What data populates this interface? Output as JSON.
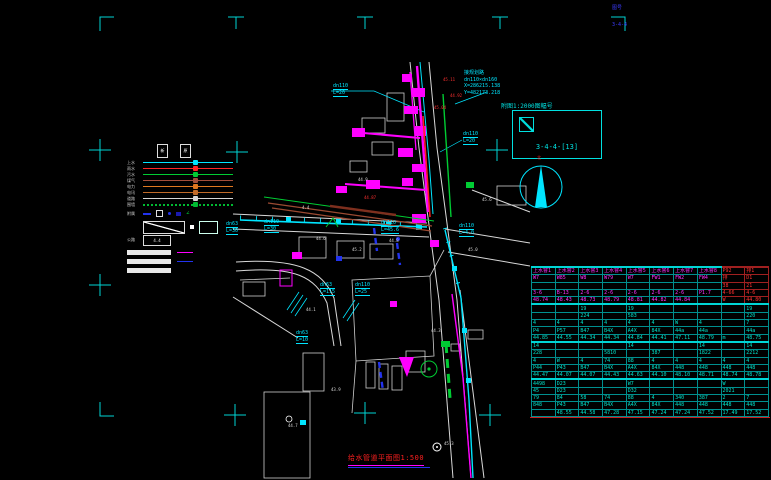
{
  "canvas": {
    "width": 771,
    "height": 480,
    "background": "#000000"
  },
  "title_block": {
    "text": "给水管道平面图",
    "scale": "1:500"
  },
  "detail_locator": {
    "caption": "附图1:2000图幅号",
    "sheet_code": "3-4-4-[13]"
  },
  "north_arrow": {
    "label": "北"
  },
  "corner_notes": [
    {
      "text": "图号",
      "x": 612,
      "y": 5
    },
    {
      "text": "3-4-4",
      "x": 612,
      "y": 22
    }
  ],
  "survey_note": {
    "lines": [
      "接规划路",
      "dn110×dn160",
      "X=286215.138",
      "Y=482173.218"
    ]
  },
  "legend": {
    "col_headers": [
      "新",
      "原"
    ],
    "lines": [
      {
        "label": "上水",
        "color": "#00e5ff",
        "dotted": false
      },
      {
        "label": "雨水",
        "color": "#ff2525",
        "dotted": false
      },
      {
        "label": "污水",
        "color": "#00cc33",
        "dotted": false
      },
      {
        "label": "煤气",
        "color": "#a34f3c",
        "dotted": false
      },
      {
        "label": "电力",
        "color": "#e07820",
        "dotted": false
      },
      {
        "label": "电讯",
        "color": "#c06a28",
        "dotted": false
      },
      {
        "label": "道路",
        "color": "#d6d6d6",
        "dotted": false
      },
      {
        "label": "围墙",
        "color": "#00bb33",
        "dotted": true
      }
    ],
    "symbols_label": "附属",
    "road_label": "公路",
    "road_box_text": "4.4"
  },
  "pipe_labels": [
    {
      "size": "dn110",
      "len": "L=20",
      "x": 333,
      "y": 83
    },
    {
      "size": "dn110",
      "len": "L=20",
      "x": 463,
      "y": 131
    },
    {
      "size": "dn63",
      "len": "L=30",
      "x": 226,
      "y": 221
    },
    {
      "size": "dn110",
      "len": "L=30",
      "x": 264,
      "y": 219
    },
    {
      "size": "dn110",
      "len": "L=45.6",
      "x": 381,
      "y": 220
    },
    {
      "size": "dn110",
      "len": "L=4.0",
      "x": 459,
      "y": 223
    },
    {
      "size": "dn63",
      "len": "L=115",
      "x": 320,
      "y": 282
    },
    {
      "size": "dn110",
      "len": "L=25",
      "x": 355,
      "y": 282
    },
    {
      "size": "dn63",
      "len": "L=10",
      "x": 296,
      "y": 330
    }
  ],
  "map_labels": {
    "white": [
      {
        "t": "4.4",
        "x": 302,
        "y": 206
      },
      {
        "t": "44.6",
        "x": 316,
        "y": 237
      },
      {
        "t": "45.2",
        "x": 352,
        "y": 248
      },
      {
        "t": "44.8",
        "x": 389,
        "y": 239
      },
      {
        "t": "45.0",
        "x": 468,
        "y": 248
      },
      {
        "t": "44.1",
        "x": 306,
        "y": 308
      },
      {
        "t": "43.9",
        "x": 331,
        "y": 388
      },
      {
        "t": "44.3",
        "x": 431,
        "y": 329
      },
      {
        "t": "45.6",
        "x": 482,
        "y": 198
      },
      {
        "t": "44.9",
        "x": 358,
        "y": 178
      },
      {
        "t": "44.7",
        "x": 288,
        "y": 424
      },
      {
        "t": "45.3",
        "x": 444,
        "y": 442
      }
    ],
    "red": [
      {
        "t": "45.11",
        "x": 443,
        "y": 78
      },
      {
        "t": "44.92",
        "x": 450,
        "y": 94
      },
      {
        "t": "45.04",
        "x": 434,
        "y": 106
      },
      {
        "t": "44.87",
        "x": 364,
        "y": 196
      }
    ]
  },
  "table": {
    "columns": 10,
    "sections": [
      {
        "text_color": "#ff2fff",
        "accent_cols": [
          8,
          9
        ],
        "accent_color": "#ff3030",
        "rows": [
          [
            "上水窨1",
            "上水窨2",
            "上水窨3",
            "上水窨4",
            "上水窨5",
            "上水窨6",
            "上水窨7",
            "上水窨8",
            "P92",
            "排1"
          ],
          [
            "W7",
            "W85",
            "W8",
            "W79",
            "W7",
            "FW1",
            "FW2",
            "FW4",
            "排",
            "D1"
          ],
          [
            "",
            "",
            "",
            "",
            "",
            "",
            "",
            "",
            "38",
            "21"
          ],
          [
            "3-6",
            "B-13",
            "2-6",
            "2-6",
            "2-6",
            "2-6",
            "2-6",
            "P1.7",
            "4-66",
            "4-6"
          ],
          [
            "48.74",
            "48.43",
            "48.73",
            "48.79",
            "48.81",
            "44.82",
            "44.84",
            "",
            "W",
            "44.80"
          ]
        ]
      },
      {
        "text_color": "#00e0c8",
        "accent_cols": [],
        "accent_color": "",
        "rows": [
          [
            "",
            "",
            "19",
            "",
            "19",
            "",
            "",
            "",
            "",
            "19"
          ],
          [
            "",
            "",
            "224",
            "",
            "583",
            "",
            "",
            "",
            "",
            "220"
          ],
          [
            "4",
            "4",
            "4",
            "4",
            "4",
            "4",
            "W",
            "4",
            "",
            "7"
          ],
          [
            "P4",
            "P57",
            "B47",
            "B4X",
            "A4X",
            "84X",
            "44a",
            "44a",
            "",
            "44a"
          ],
          [
            "44.85",
            "44.55",
            "44.34",
            "44.34",
            "44.84",
            "44.41",
            "47.11",
            "48.79",
            "m",
            "48.75"
          ]
        ]
      },
      {
        "text_color": "#00e0c8",
        "accent_cols": [],
        "accent_color": "",
        "rows": [
          [
            "14",
            "",
            "",
            "",
            "14",
            "",
            "",
            "14",
            "",
            "14"
          ],
          [
            "228",
            "",
            "",
            "5810",
            "",
            "387",
            "",
            "1822",
            "",
            "2212"
          ],
          [
            "4",
            "W",
            "4",
            "74",
            "88",
            "4",
            "4",
            "4",
            "4",
            "4"
          ],
          [
            "P44",
            "P43",
            "B47",
            "B4X",
            "A4X",
            "84X",
            "448",
            "448",
            "448",
            "448"
          ],
          [
            "44.47",
            "44.07",
            "44.07",
            "44.43",
            "44.63",
            "44.10",
            "48.10",
            "48.71",
            "48.74",
            "48.78"
          ]
        ]
      },
      {
        "text_color": "#00e0c8",
        "accent_cols": [],
        "accent_color": "",
        "rows": [
          [
            "4498",
            "D23",
            "",
            "",
            "W7",
            "",
            "",
            "",
            "W",
            ""
          ],
          [
            "45",
            "D23",
            "",
            "",
            "D32",
            "",
            "",
            "",
            "2021",
            ""
          ],
          [
            "79",
            "84",
            "58",
            "74",
            "88",
            "4",
            "340",
            "387",
            "2",
            "7"
          ],
          [
            "848",
            "P43",
            "B47",
            "B4X",
            "A4X",
            "84X",
            "448",
            "448",
            "448",
            "448"
          ],
          [
            "",
            "48.55",
            "44.58",
            "47.28",
            "47.15",
            "47.24",
            "47.24",
            "47.52",
            "17.49",
            "17.52"
          ]
        ]
      }
    ]
  }
}
